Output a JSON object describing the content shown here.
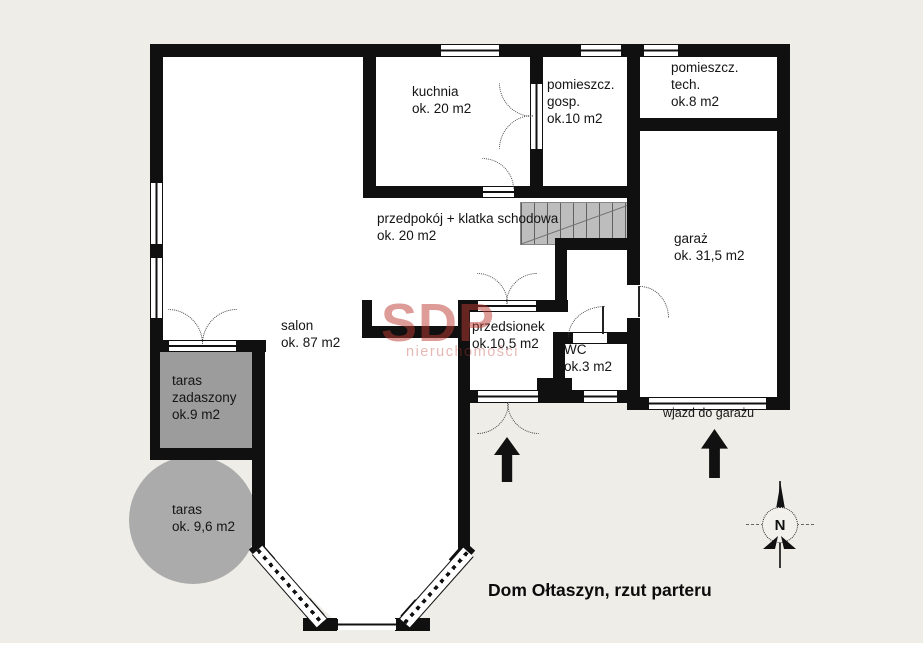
{
  "title": "Dom Ołtaszyn, rzut parteru",
  "watermark": {
    "brand": "SDP",
    "tagline": "nieruchomości"
  },
  "compass": {
    "north_label": "N"
  },
  "annotations": {
    "garage_driveway": "wjazd do garażu"
  },
  "rooms": {
    "salon": {
      "lines": [
        "salon",
        "ok. 87 m2"
      ]
    },
    "kuchnia": {
      "lines": [
        "kuchnia",
        "ok. 20 m2"
      ]
    },
    "pom_gosp": {
      "lines": [
        "pomieszcz.",
        "gosp.",
        "ok.10 m2"
      ]
    },
    "pom_tech": {
      "lines": [
        "pomieszcz.",
        "tech.",
        "ok.8 m2"
      ]
    },
    "garaz": {
      "lines": [
        "garaż",
        "ok. 31,5 m2"
      ]
    },
    "przedpokoj": {
      "lines": [
        "przedpokój + klatka schodowa",
        "ok. 20 m2"
      ]
    },
    "przedsionek": {
      "lines": [
        "przedsionek",
        "ok.10,5 m2"
      ]
    },
    "wc": {
      "lines": [
        "WC",
        "ok.3 m2"
      ]
    },
    "taras_zadaszony": {
      "lines": [
        "taras",
        "zadaszony",
        "ok.9 m2"
      ]
    },
    "taras": {
      "lines": [
        "taras",
        "ok. 9,6 m2"
      ]
    }
  },
  "colors": {
    "background": "#efede7",
    "walls": "#101010",
    "floor": "#ffffff",
    "covered_terrace": "#9c9c9c",
    "terrace_circle": "#ababab",
    "stairs": "#bdbdbd",
    "watermark": "#bb3a2f"
  }
}
